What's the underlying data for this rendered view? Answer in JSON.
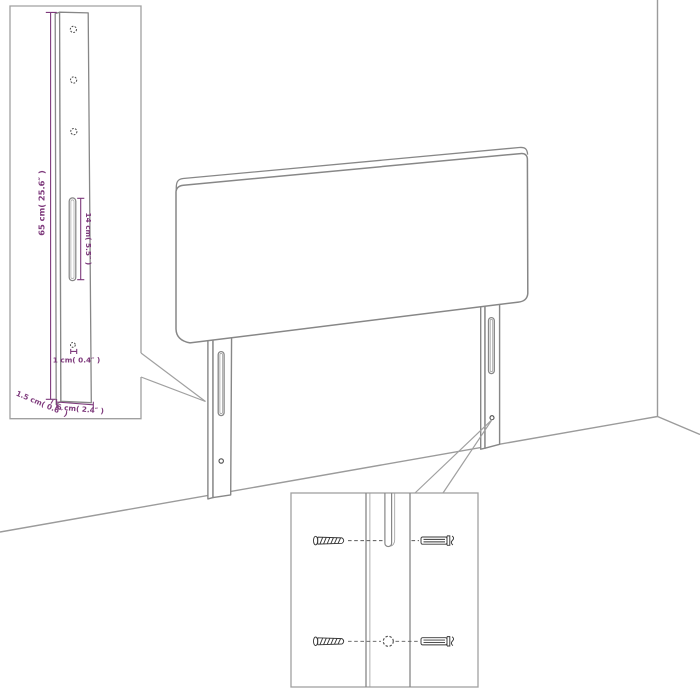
{
  "dimensions": {
    "leg_height": "65 cm( 25.6″ )",
    "slot_length": "14 cm( 5.5″ )",
    "hole_diameter": "1 cm( 0.4″ )",
    "leg_thickness": "1.5 cm( 0.6″ )",
    "leg_width": "6 cm( 2.4″ )"
  },
  "colors": {
    "dimension_accent": "#7e3a7c",
    "outline_gray": "#878787",
    "border_gray": "#a0a0a0",
    "hardware_dark": "#383838",
    "background": "#ffffff"
  }
}
